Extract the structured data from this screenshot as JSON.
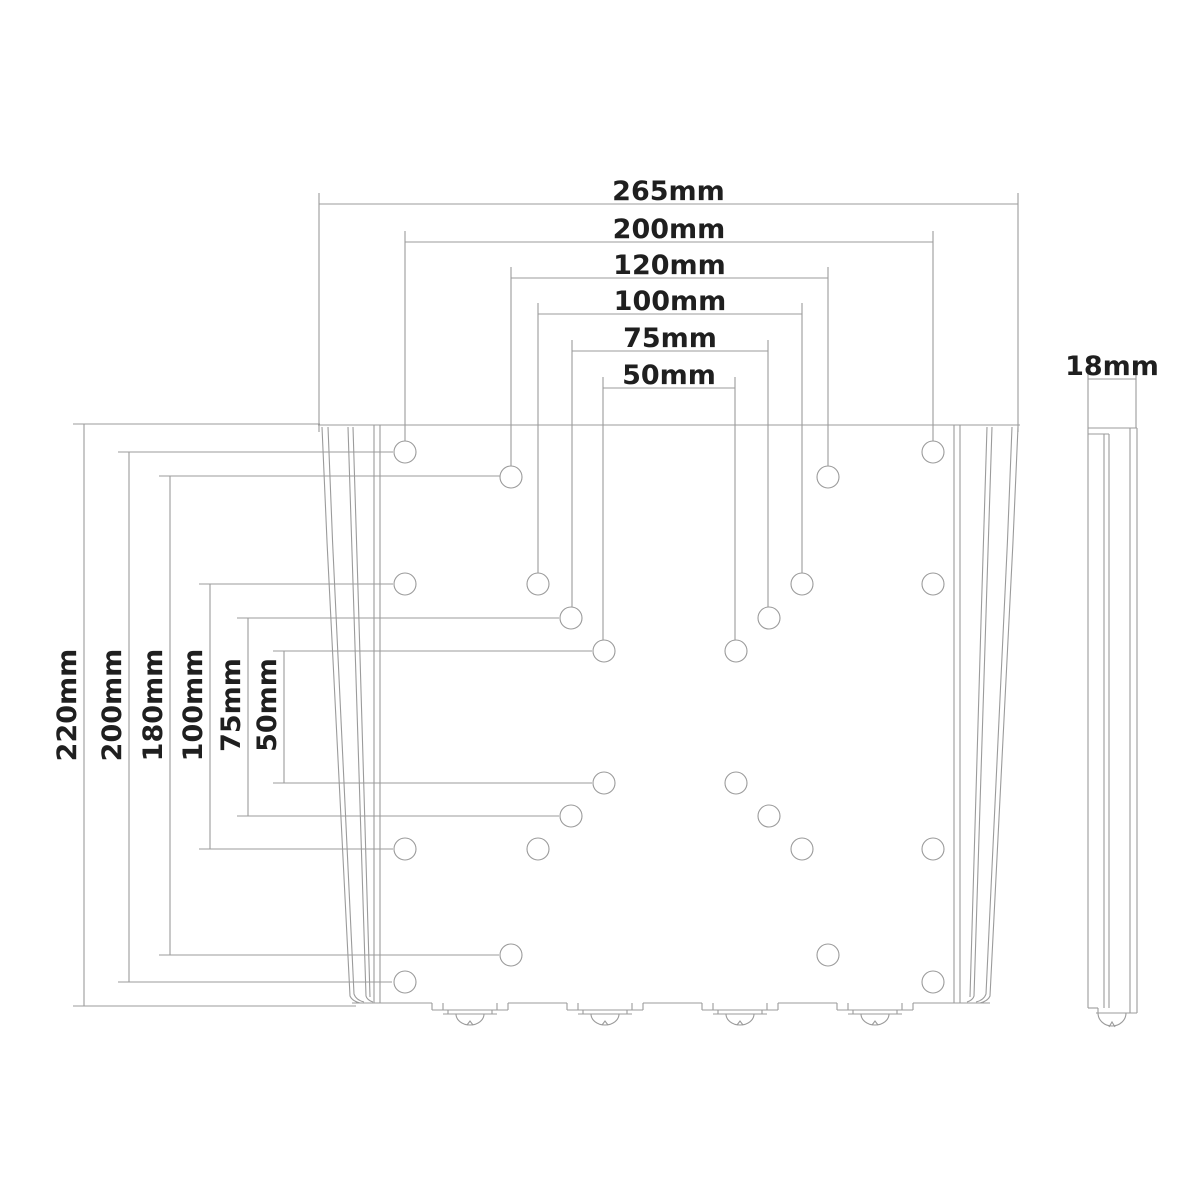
{
  "page": {
    "background": "#ffffff",
    "line_color": "#9b9b9b",
    "text_color": "#1f1f1f",
    "description_labels": {
      "drawing_type": "wall-mount-plate-dimension-drawing"
    }
  },
  "front_view": {
    "plate": {
      "top_edge": {
        "x1": 318,
        "y": 425,
        "x2": 1020
      },
      "bottom_edge": {
        "y": 1003,
        "x1": 352,
        "x2": 990
      },
      "inner_vertical_lines_left": [
        374,
        380
      ],
      "inner_vertical_lines_right": [
        954,
        960
      ]
    },
    "holes": {
      "radius": 11,
      "positions": [
        [
          405,
          452
        ],
        [
          933,
          452
        ],
        [
          511,
          477
        ],
        [
          828,
          477
        ],
        [
          405,
          584
        ],
        [
          538,
          584
        ],
        [
          802,
          584
        ],
        [
          933,
          584
        ],
        [
          571,
          618
        ],
        [
          769,
          618
        ],
        [
          604,
          651
        ],
        [
          736,
          651
        ],
        [
          604,
          783
        ],
        [
          736,
          783
        ],
        [
          571,
          816
        ],
        [
          769,
          816
        ],
        [
          405,
          849
        ],
        [
          538,
          849
        ],
        [
          802,
          849
        ],
        [
          933,
          849
        ],
        [
          511,
          955
        ],
        [
          828,
          955
        ],
        [
          405,
          982
        ],
        [
          933,
          982
        ]
      ]
    },
    "tabs": {
      "centers": [
        470,
        605,
        740,
        875
      ]
    }
  },
  "dimensions": {
    "top": [
      {
        "label": "265mm",
        "value_mm": 265,
        "x1": 319,
        "x2": 1018,
        "y": 204,
        "drop_to": 432
      },
      {
        "label": "200mm",
        "value_mm": 200,
        "x1": 405,
        "x2": 933,
        "y": 242,
        "drop_to": 441
      },
      {
        "label": "120mm",
        "value_mm": 120,
        "x1": 511,
        "x2": 828,
        "y": 278,
        "drop_to": 466
      },
      {
        "label": "100mm",
        "value_mm": 100,
        "x1": 538,
        "x2": 802,
        "y": 314,
        "drop_to": 573
      },
      {
        "label": "75mm",
        "value_mm": 75,
        "x1": 572,
        "x2": 768,
        "y": 351,
        "drop_to": 607
      },
      {
        "label": "50mm",
        "value_mm": 50,
        "x1": 603,
        "x2": 735,
        "y": 388,
        "drop_to": 640
      }
    ],
    "left": [
      {
        "label": "220mm",
        "value_mm": 220,
        "x": 84,
        "y1": 424,
        "y2": 1006,
        "ext_to": [
          320,
          356
        ]
      },
      {
        "label": "200mm",
        "value_mm": 200,
        "x": 129,
        "y1": 452,
        "y2": 982,
        "ext_to": [
          393,
          392
        ]
      },
      {
        "label": "180mm",
        "value_mm": 180,
        "x": 170,
        "y1": 476,
        "y2": 955,
        "ext_to": [
          500,
          499
        ]
      },
      {
        "label": "100mm",
        "value_mm": 100,
        "x": 210,
        "y1": 584,
        "y2": 849,
        "ext_to": [
          393,
          393
        ]
      },
      {
        "label": "75mm",
        "value_mm": 75,
        "x": 248,
        "y1": 618,
        "y2": 816,
        "ext_to": [
          559,
          559
        ]
      },
      {
        "label": "50mm",
        "value_mm": 50,
        "x": 284,
        "y1": 651,
        "y2": 783,
        "ext_to": [
          592,
          592
        ]
      }
    ],
    "left_label_center_y": 705,
    "side": {
      "label": "18mm",
      "value_mm": 18,
      "x1": 1088,
      "x2": 1136,
      "y": 379,
      "drop_to": 428
    }
  }
}
